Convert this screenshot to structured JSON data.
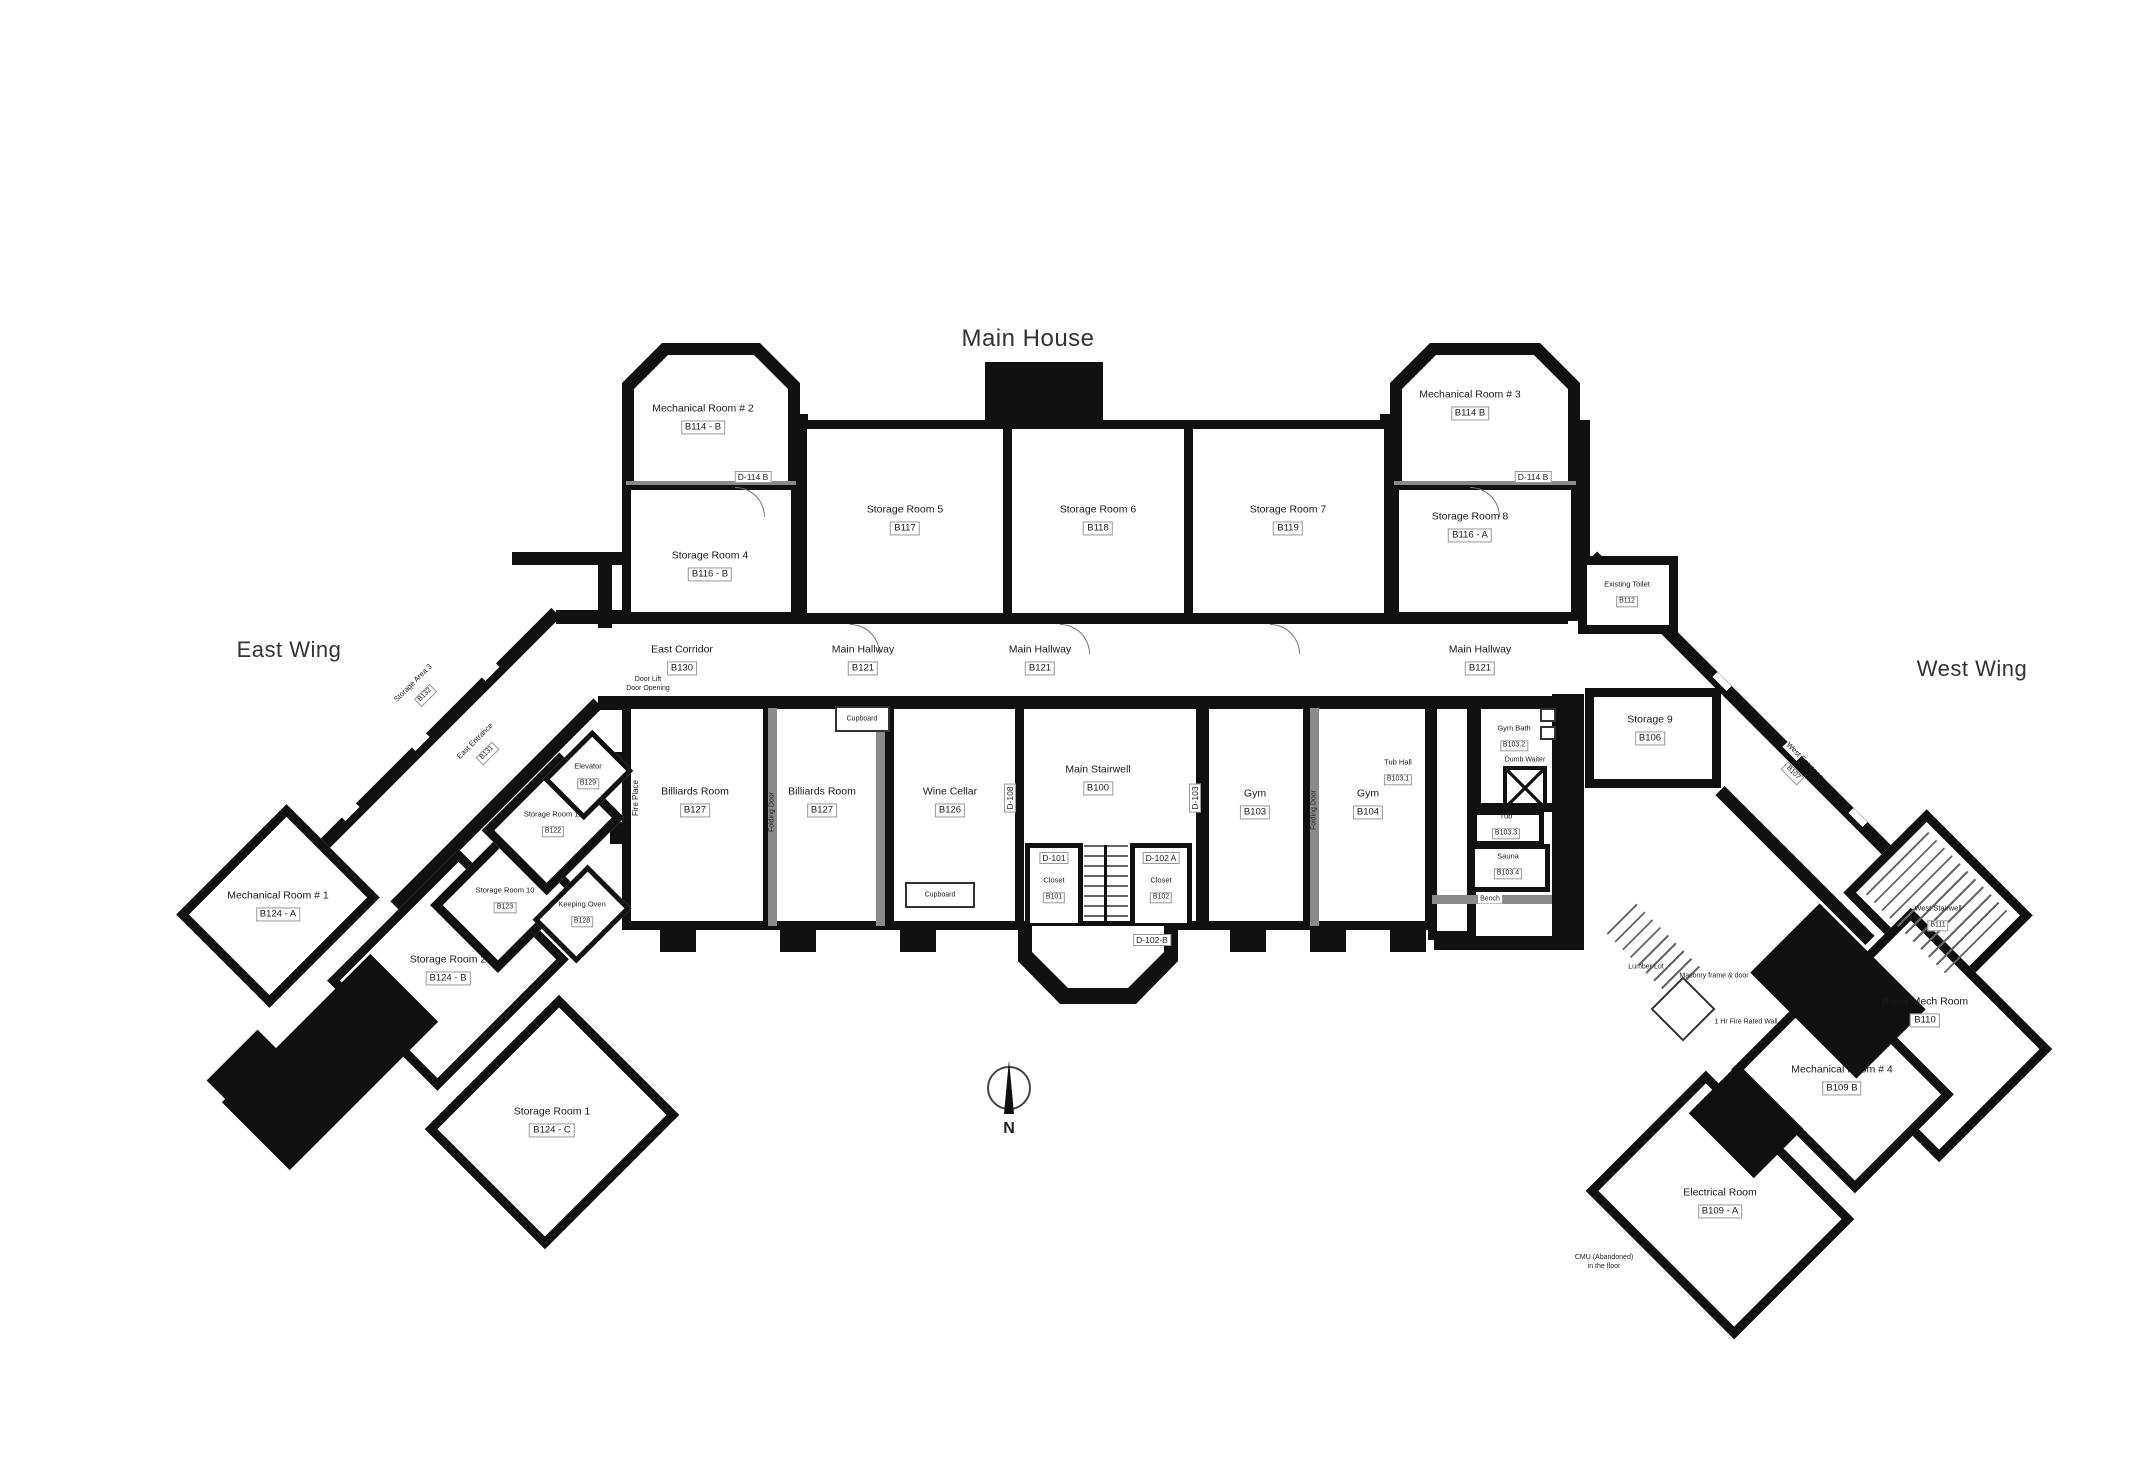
{
  "labels": {
    "title": "Main House",
    "east_wing": "East Wing",
    "west_wing": "West Wing",
    "north": "N"
  },
  "rooms": [
    {
      "name": "Mechanical Room # 2",
      "id": "B114 - B"
    },
    {
      "name": "Storage Room 4",
      "id": "B116 - B"
    },
    {
      "name": "Storage Room 5",
      "id": "B117"
    },
    {
      "name": "Storage Room 6",
      "id": "B118"
    },
    {
      "name": "Storage Room 7",
      "id": "B119"
    },
    {
      "name": "Mechanical Room # 3",
      "id": "B114 B"
    },
    {
      "name": "Storage Room 8",
      "id": "B116 - A"
    },
    {
      "name": "East Corridor",
      "id": "B130"
    },
    {
      "name": "Main Hallway",
      "id": "B121"
    },
    {
      "name": "Main Hallway",
      "id": "B121"
    },
    {
      "name": "Main Hallway",
      "id": "B121"
    },
    {
      "name": "Billiards Room",
      "id": "B127"
    },
    {
      "name": "Billiards Room",
      "id": "B127"
    },
    {
      "name": "Wine Cellar",
      "id": "B126"
    },
    {
      "name": "Main Stairwell",
      "id": "B100"
    },
    {
      "name": "Closet",
      "id": "B101"
    },
    {
      "name": "Closet",
      "id": "B102"
    },
    {
      "name": "Gym",
      "id": "B103"
    },
    {
      "name": "Gym",
      "id": "B104"
    },
    {
      "name": "Tub Hall",
      "id": "B103.1"
    },
    {
      "name": "Gym Bath",
      "id": "B103.2"
    },
    {
      "name": "Tub",
      "id": "B103.3"
    },
    {
      "name": "Sauna",
      "id": "B103.4"
    },
    {
      "name": "Storage 9",
      "id": "B106"
    },
    {
      "name": "Existing Toilet",
      "id": "B112"
    },
    {
      "name": "Storage Area 3",
      "id": "B132"
    },
    {
      "name": "East Entrance",
      "id": "B131"
    },
    {
      "name": "Elevator",
      "id": "B129"
    },
    {
      "name": "Storage Room 11",
      "id": "B122"
    },
    {
      "name": "Storage Room 10",
      "id": "B123"
    },
    {
      "name": "Keeping Oven",
      "id": "B128"
    },
    {
      "name": "Mechanical Room # 1",
      "id": "B124 - A"
    },
    {
      "name": "Storage Room 2",
      "id": "B124 - B"
    },
    {
      "name": "Storage Room 1",
      "id": "B124 - C"
    },
    {
      "name": "West Stairwell",
      "id": "B111"
    },
    {
      "name": "Boiler Mech Room",
      "id": "B110"
    },
    {
      "name": "Mechanical Room # 4",
      "id": "B109 B"
    },
    {
      "name": "Electrical Room",
      "id": "B109 - A"
    },
    {
      "name": "West Entrance",
      "id": "B107"
    }
  ],
  "annotations": {
    "fire_place": "Fire Place",
    "folding_door": "Folding Door",
    "cupboard": "Cupboard",
    "bench": "Bench",
    "dumb_waiter": "Dumb Waiter",
    "door_lift_1": "Door Lift",
    "door_lift_2": "Door Opening",
    "lumber_lot": "Lumber Lot",
    "masonry": "Masonry frame & door",
    "fire_rated": "1 Hr Fire Rated Wall",
    "cmu_1": "CMU (Abandoned)",
    "cmu_2": "in the floor"
  },
  "doors": {
    "d114b": "D-114 B",
    "d108": "D-108",
    "d103": "D-103",
    "d101": "D-101",
    "d102a": "D-102 A",
    "d102b": "D-102-B"
  },
  "colors": {
    "wall": "#101010",
    "partition": "#8a8a8a",
    "text": "#1a1a1a",
    "background": "#ffffff"
  }
}
